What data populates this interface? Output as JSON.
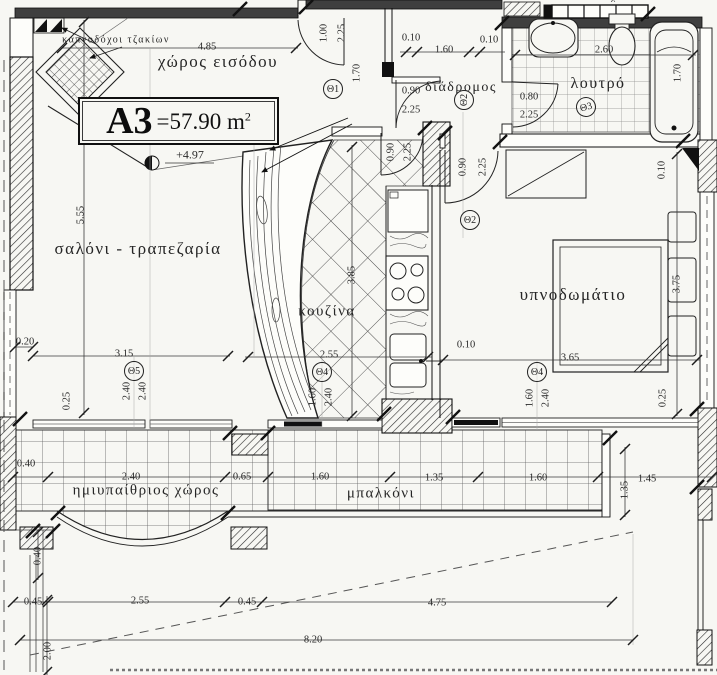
{
  "title_box": {
    "unit": "A3",
    "eq": "=",
    "area": "57.90",
    "area_unit": "m",
    "exponent": "2"
  },
  "level_marker": {
    "value": "+4.97"
  },
  "rooms": {
    "entrance": "χώρος εισόδου",
    "corridor": "διάδρομος",
    "bathroom": "λουτρό",
    "living_dining": "σαλόνι - τραπεζαρία",
    "kitchen": "κουζίνα",
    "bedroom": "υπνοδωμάτιο",
    "semi_outdoor": "ημιυπαίθριος χώρος",
    "balcony": "μπαλκόνι",
    "chimneys_note": "καπνοδόχοι τζακίων"
  },
  "labels": [
    {
      "t": "καπνοδόχοι τζακίων",
      "x": 116,
      "y": 40,
      "fs": 10,
      "c": "room",
      "n": "label-chimneys"
    },
    {
      "t": "χώρος εισόδου",
      "x": 218,
      "y": 62,
      "fs": 17,
      "c": "room",
      "n": "label-entrance"
    },
    {
      "t": "διάδρομος",
      "x": 461,
      "y": 88,
      "fs": 14,
      "c": "room",
      "n": "label-corridor"
    },
    {
      "t": "λουτρό",
      "x": 598,
      "y": 84,
      "fs": 16,
      "c": "room",
      "n": "label-bathroom"
    },
    {
      "t": "σαλόνι - τραπεζαρία",
      "x": 138,
      "y": 249,
      "fs": 17,
      "c": "room",
      "n": "label-living-dining"
    },
    {
      "t": "κουζίνα",
      "x": 327,
      "y": 312,
      "fs": 15,
      "c": "room",
      "n": "label-kitchen"
    },
    {
      "t": "υπνοδωμάτιο",
      "x": 573,
      "y": 295,
      "fs": 17,
      "c": "room",
      "n": "label-bedroom"
    },
    {
      "t": "ημιυπαίθριος χώρος",
      "x": 146,
      "y": 491,
      "fs": 15,
      "c": "room",
      "n": "label-semi-outdoor"
    },
    {
      "t": "μπαλκόνι",
      "x": 381,
      "y": 494,
      "fs": 15,
      "c": "room",
      "n": "label-balcony"
    },
    {
      "t": "καπνοδόχοι",
      "x": 598,
      "y": -3,
      "fs": 9,
      "c": "room",
      "n": "label-top-clipped"
    },
    {
      "t": "+4.97",
      "x": 190,
      "y": 155,
      "fs": 12,
      "n": "level-value"
    },
    {
      "t": "4.85",
      "x": 207,
      "y": 47
    },
    {
      "t": "1.00",
      "x": 324,
      "y": 33,
      "r": -90
    },
    {
      "t": "2.25",
      "x": 342,
      "y": 33,
      "r": -90
    },
    {
      "t": "1.70",
      "x": 357,
      "y": 73,
      "r": -90
    },
    {
      "t": "0.10",
      "x": 411,
      "y": 38
    },
    {
      "t": "1.60",
      "x": 444,
      "y": 50
    },
    {
      "t": "0.10",
      "x": 489,
      "y": 40
    },
    {
      "t": "2.60",
      "x": 604,
      "y": 50
    },
    {
      "t": "1.70",
      "x": 678,
      "y": 73,
      "r": -90
    },
    {
      "t": "0.90",
      "x": 411,
      "y": 91
    },
    {
      "t": "2.25",
      "x": 411,
      "y": 110
    },
    {
      "t": "0.80",
      "x": 529,
      "y": 97
    },
    {
      "t": "2.25",
      "x": 529,
      "y": 115
    },
    {
      "t": "0.90",
      "x": 391,
      "y": 152,
      "r": -90
    },
    {
      "t": "2.25",
      "x": 408,
      "y": 152,
      "r": -90
    },
    {
      "t": "0.90",
      "x": 463,
      "y": 167,
      "r": -90
    },
    {
      "t": "2.25",
      "x": 483,
      "y": 167,
      "r": -90
    },
    {
      "t": "0.10",
      "x": 662,
      "y": 170,
      "r": -90
    },
    {
      "t": "5.55",
      "x": 81,
      "y": 215,
      "r": -90
    },
    {
      "t": "3.85",
      "x": 352,
      "y": 275,
      "r": -90
    },
    {
      "t": "3.75",
      "x": 677,
      "y": 284,
      "r": -90
    },
    {
      "t": "0.20",
      "x": 25,
      "y": 342
    },
    {
      "t": "3.15",
      "x": 124,
      "y": 354
    },
    {
      "t": "2.55",
      "x": 329,
      "y": 355
    },
    {
      "t": "0.10",
      "x": 466,
      "y": 345
    },
    {
      "t": "3.65",
      "x": 570,
      "y": 358
    },
    {
      "t": "2.40",
      "x": 127,
      "y": 391,
      "r": -90
    },
    {
      "t": "2.40",
      "x": 143,
      "y": 391,
      "r": -90
    },
    {
      "t": "0.25",
      "x": 67,
      "y": 401,
      "r": -90
    },
    {
      "t": "1.60",
      "x": 313,
      "y": 397,
      "r": -90
    },
    {
      "t": "2.40",
      "x": 329,
      "y": 397,
      "r": -90
    },
    {
      "t": "1.60",
      "x": 530,
      "y": 398,
      "r": -90
    },
    {
      "t": "2.40",
      "x": 546,
      "y": 398,
      "r": -90
    },
    {
      "t": "0.25",
      "x": 663,
      "y": 398,
      "r": -90
    },
    {
      "t": "0.40",
      "x": 26,
      "y": 464
    },
    {
      "t": "2.40",
      "x": 131,
      "y": 477
    },
    {
      "t": "0.65",
      "x": 242,
      "y": 477
    },
    {
      "t": "1.60",
      "x": 320,
      "y": 477
    },
    {
      "t": "1.35",
      "x": 434,
      "y": 478
    },
    {
      "t": "1.60",
      "x": 538,
      "y": 478
    },
    {
      "t": "1.35",
      "x": 625,
      "y": 490,
      "r": -90
    },
    {
      "t": "1.45",
      "x": 647,
      "y": 479
    },
    {
      "t": "0.40",
      "x": 38,
      "y": 556,
      "r": -90
    },
    {
      "t": "0.45",
      "x": 33,
      "y": 602
    },
    {
      "t": "2.55",
      "x": 140,
      "y": 601
    },
    {
      "t": "0.45",
      "x": 247,
      "y": 602
    },
    {
      "t": "4.75",
      "x": 437,
      "y": 603
    },
    {
      "t": "2.00",
      "x": 48,
      "y": 651,
      "r": -90
    },
    {
      "t": "8.20",
      "x": 313,
      "y": 640
    }
  ],
  "door_tags": [
    {
      "t": "Θ1",
      "x": 333,
      "y": 89
    },
    {
      "t": "Θ2",
      "x": 464,
      "y": 100,
      "r": -90
    },
    {
      "t": "Θ3",
      "x": 586,
      "y": 107,
      "r": -15
    },
    {
      "t": "Θ2",
      "x": 470,
      "y": 220
    },
    {
      "t": "Θ5",
      "x": 134,
      "y": 371
    },
    {
      "t": "Θ4",
      "x": 322,
      "y": 372
    },
    {
      "t": "Θ4",
      "x": 537,
      "y": 372
    }
  ]
}
